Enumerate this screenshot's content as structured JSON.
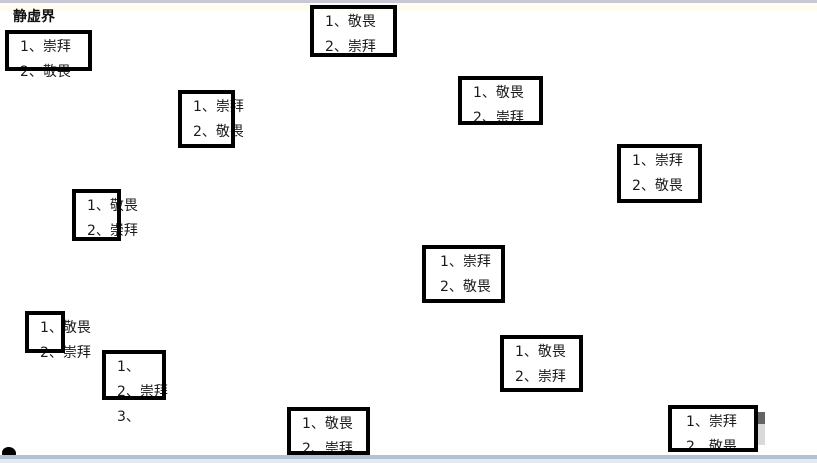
{
  "page": {
    "title": "静虚界"
  },
  "colors": {
    "background": "#ffffff",
    "box_border": "#000000",
    "text": "#1b1b1b",
    "top_bar": "#c8c8d4",
    "bottom_bar": "#b3c1d4",
    "bottom_strip": "#e4eaf2"
  },
  "icons": {
    "bottom_left": "ink-blob-icon"
  },
  "boxes": [
    {
      "lines": [
        "1、崇拜",
        "2、敬畏"
      ]
    },
    {
      "lines": [
        "1、敬畏",
        "2、崇拜"
      ]
    },
    {
      "lines": [
        "1、崇拜",
        "2、敬畏"
      ]
    },
    {
      "lines": [
        "1、敬畏",
        "2、崇拜"
      ]
    },
    {
      "lines": [
        "1、崇拜",
        "2、敬畏"
      ]
    },
    {
      "lines": [
        "1、敬畏",
        "2、崇拜"
      ]
    },
    {
      "lines": [
        "1、崇拜",
        "2、敬畏"
      ]
    },
    {
      "lines": [
        "1、敬畏",
        "2、崇拜"
      ]
    },
    {
      "lines": [
        "1、",
        "2、崇拜",
        "3、"
      ]
    },
    {
      "lines": [
        "1、敬畏",
        "2、崇拜"
      ]
    },
    {
      "lines": [
        "1、敬畏",
        "2、崇拜"
      ]
    },
    {
      "lines": [
        "1、崇拜",
        "2、敬畏"
      ]
    }
  ]
}
